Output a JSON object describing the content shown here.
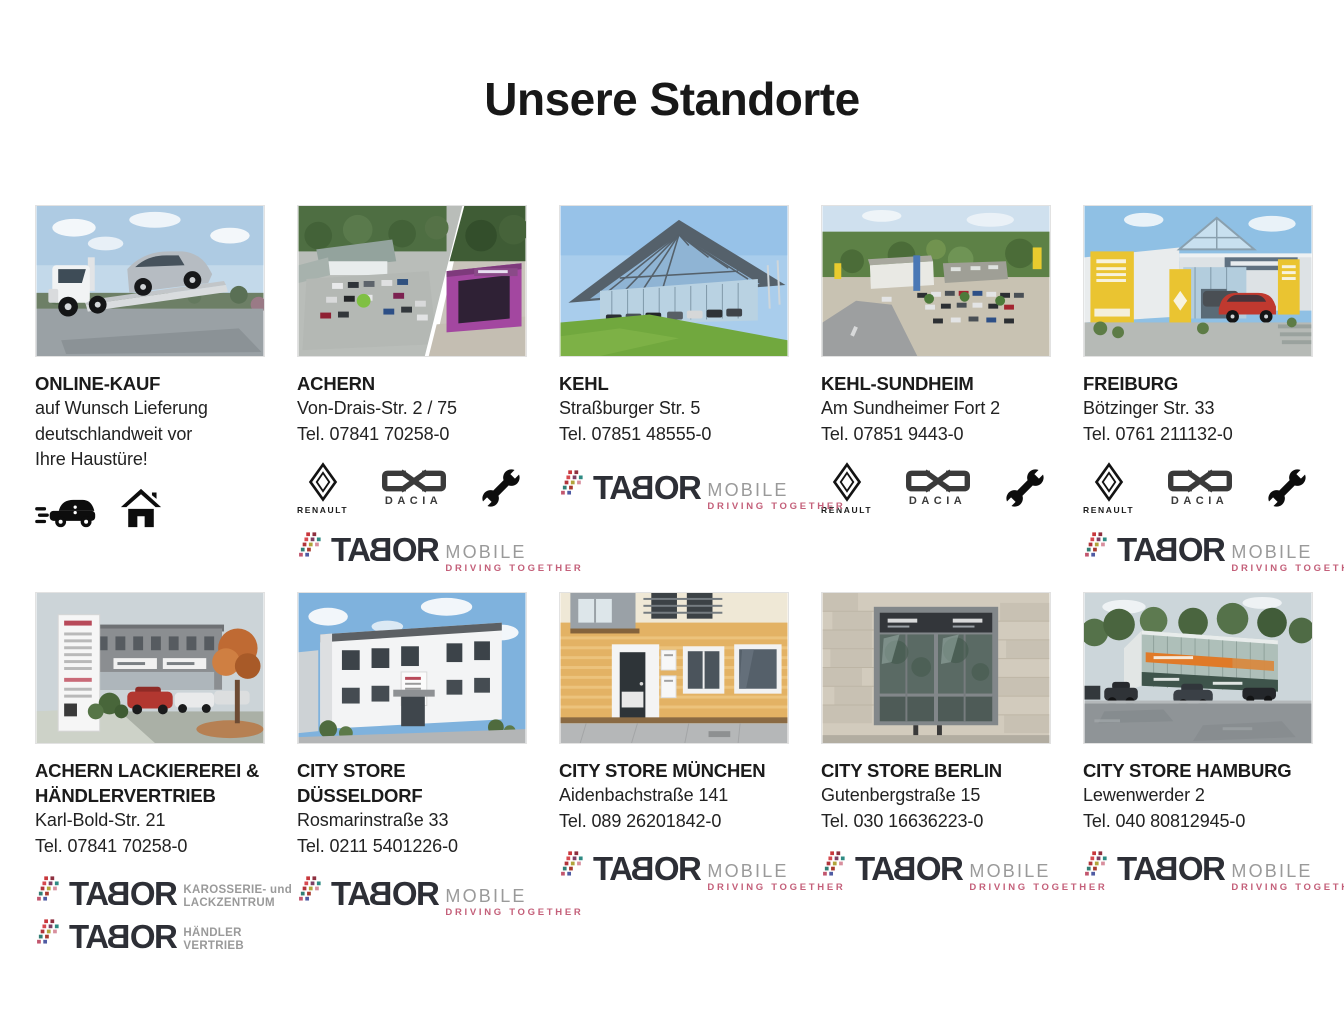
{
  "page": {
    "title": "Unsere Standorte"
  },
  "colors": {
    "title": "#181818",
    "text": "#222222",
    "tabor_dark": "#2d2f36",
    "tabor_gray": "#9a9a9a",
    "tabor_pink": "#c4607a",
    "renault_black": "#131313",
    "dacia_gray": "#3a3a3a"
  },
  "logos": {
    "renault_label": "RENAULT",
    "dacia_label": "DACIA",
    "tabor": {
      "word_parts": [
        "TA",
        "B",
        "OR"
      ],
      "mobile": "MOBILE",
      "tagline": "DRIVING TOGETHER",
      "karosserie_top": "KAROSSERIE- und",
      "karosserie_bottom": "LACKZENTRUM",
      "haendler_top": "HÄNDLER",
      "haendler_bottom": "VERTRIEB",
      "dot_colors": [
        "#c8373c",
        "#8e2f3f",
        "#d6494f",
        "#7d3f63",
        "#2e8a83",
        "#b1343a",
        "#b1a43c",
        "#d88f9e",
        "#317d74",
        "#a83a2f",
        "#c2566e",
        "#4f5ba3"
      ]
    }
  },
  "cards": [
    {
      "name": "ONLINE-KAUF",
      "desc": [
        "auf Wunsch Lieferung",
        "deutschlandweit vor",
        "Ihre Haustüre!"
      ]
    },
    {
      "name": "ACHERN",
      "address": "Von-Drais-Str. 2 / 75",
      "phone": "Tel. 07841 70258-0"
    },
    {
      "name": "KEHL",
      "address": "Straßburger Str. 5",
      "phone": "Tel. 07851 48555-0"
    },
    {
      "name": "KEHL-SUNDHEIM",
      "address": "Am Sundheimer Fort 2",
      "phone": "Tel. 07851 9443-0"
    },
    {
      "name": "FREIBURG",
      "address": "Bötzinger Str. 33",
      "phone": "Tel. 0761 211132-0"
    },
    {
      "name": "ACHERN LACKIEREREI & HÄNDLERVERTRIEB",
      "address": "Karl-Bold-Str. 21",
      "phone": "Tel. 07841 70258-0"
    },
    {
      "name": "CITY STORE DÜSSELDORF",
      "address": "Rosmarinstraße 33",
      "phone": "Tel. 0211 5401226-0"
    },
    {
      "name": "CITY STORE MÜNCHEN",
      "address": "Aidenbachstraße 141",
      "phone": "Tel. 089 26201842-0"
    },
    {
      "name": "CITY STORE BERLIN",
      "address": "Gutenbergstraße 15",
      "phone": "Tel. 030 16636223-0"
    },
    {
      "name": "CITY STORE HAMBURG",
      "address": "Lewenwerder 2",
      "phone": "Tel. 040 80812945-0"
    }
  ]
}
